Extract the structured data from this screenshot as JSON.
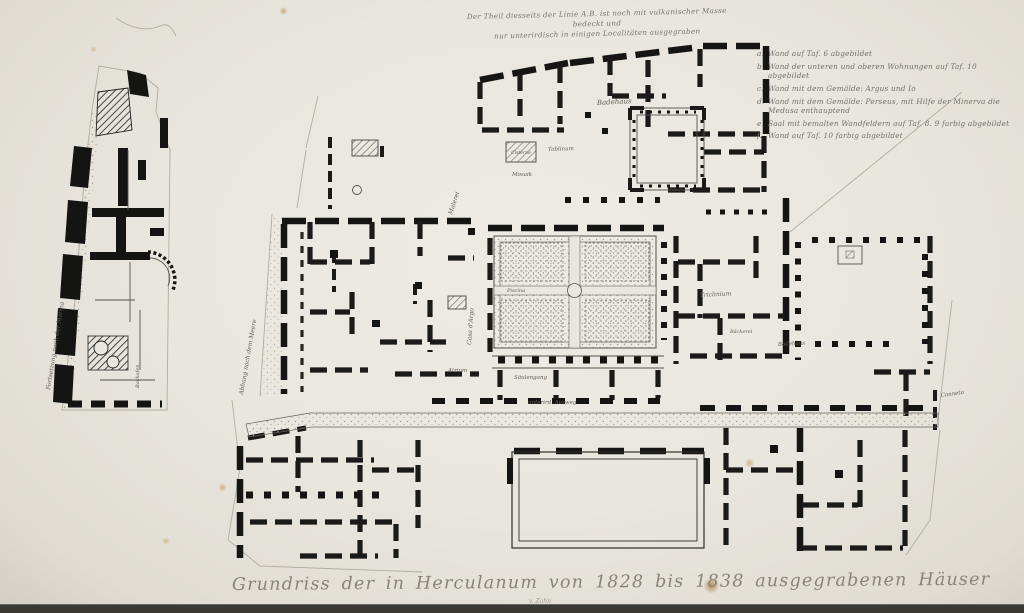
{
  "artwork": {
    "title": "Grundriss der in Herculanum von 1828 bis 1838 ausgegrabenen Häuser",
    "title_credit": "v. Zahn",
    "top_note_line1": "Der Theil diesseits der Linie A.B. ist noch mit vulkanischer Masse bedeckt und",
    "top_note_line2": "nur unterirdisch in einigen Localitäten ausgegraben"
  },
  "legend": {
    "items": [
      {
        "key": "a.",
        "text": "Wand auf Taf. 6 abgebildet"
      },
      {
        "key": "b.",
        "text": "Wand der unteren und oberen Wohnungen auf Taf. 10 abgebildet"
      },
      {
        "key": "c.",
        "text": "Wand mit dem Gemälde: Argus und Io"
      },
      {
        "key": "d.",
        "text": "Wand mit dem Gemälde: Perseus, mit Hilfe der Minerva die Medusa enthauptend"
      },
      {
        "key": "e.",
        "text": "Saal mit bemalten Wandfeldern auf Taf. 8. 9 farbig abgebildet"
      },
      {
        "key": "f.",
        "text": "Wand auf Taf. 10 farbig abgebildet"
      }
    ]
  },
  "plan_labels": {
    "badehaus_top": "Badehaus",
    "cisterne": "Cisterne",
    "tablinum": "Tablinum",
    "mosaik": "Mosaik",
    "malerei": "Malerei",
    "abhang": "Abhang nach dem Meere",
    "casa_argo": "Casa d'Argo",
    "atrium": "Atrium",
    "piscina": "Piscina",
    "saeulengang": "Säulengang",
    "triclinium": "Triclinium",
    "baeckerei": "Bäckerei",
    "badehaus_right": "Badehaus",
    "ausweg": "unterird. Ausweg",
    "canneto": "Canneto",
    "marina": "Fortsetzung nach der Marina",
    "backofen": "Backofen"
  },
  "colors": {
    "paper": "#e9e6de",
    "ink": "#141413",
    "engraved_text": "#76746c",
    "scan_edge": "#3a3933"
  }
}
